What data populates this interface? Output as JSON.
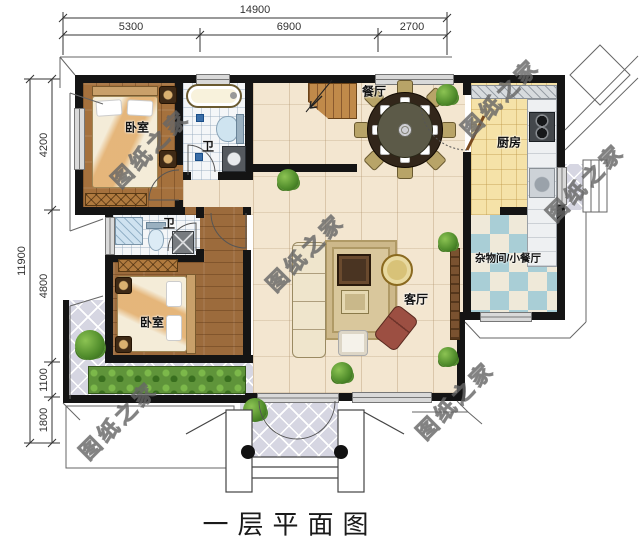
{
  "meta": {
    "title": "一层平面图",
    "watermark": "图纸之家"
  },
  "dimensions": {
    "top": {
      "total": "14900",
      "segments": [
        "5300",
        "6900",
        "2700"
      ]
    },
    "left": {
      "total": "11900",
      "segments": [
        "4200",
        "4800",
        "1100",
        "1800"
      ]
    }
  },
  "rooms": {
    "bedroom_top": {
      "label": "卧室"
    },
    "bath_top": {
      "label": "卫"
    },
    "dining": {
      "label": "餐厅"
    },
    "kitchen": {
      "label": "厨房"
    },
    "utility": {
      "label": "杂物间/小餐厅"
    },
    "living": {
      "label": "客厅"
    },
    "bedroom_bottom": {
      "label": "卧室"
    },
    "bath_mid": {
      "label": "卫"
    }
  },
  "colors": {
    "wall": "#141414",
    "wood_floor": "#a5713d",
    "main_tile": "#f3e6d0",
    "bath_tile": "#f4f6f8",
    "kitchen_tile": "#f5e2a8",
    "checker_blue": "#a9ced6",
    "checker_cream": "#efe9d9",
    "terrace_tile": "#d6d6e2",
    "accent_orange": "#d98a2e"
  }
}
